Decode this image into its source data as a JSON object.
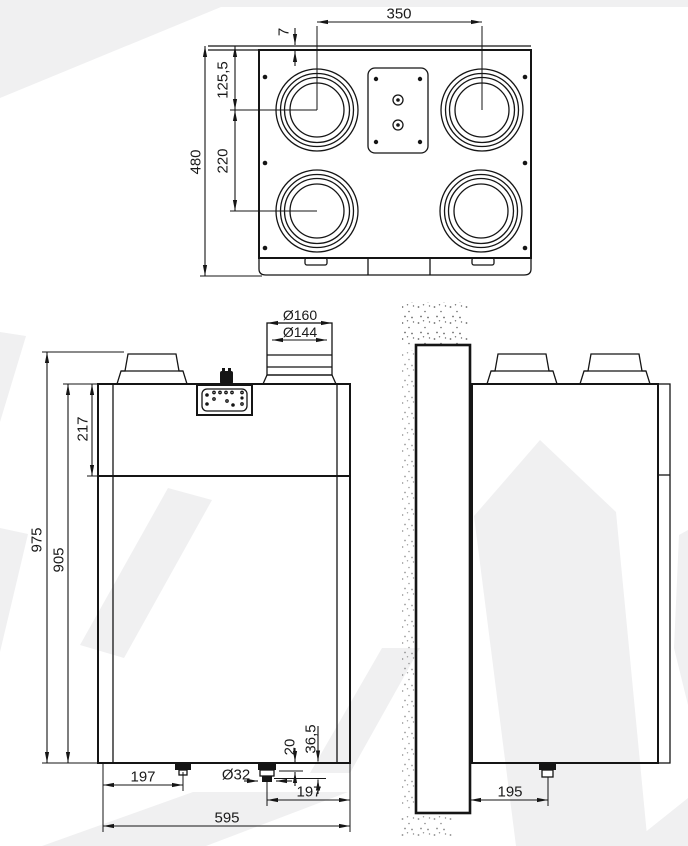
{
  "colors": {
    "line": "#151515",
    "watermark": "#f0f0f1",
    "paper": "#ffffff"
  },
  "top_view": {
    "dim_350": "350",
    "dim_7": "7",
    "dim_125_5": "125,5",
    "dim_220": "220",
    "dim_480": "480"
  },
  "front_view": {
    "dim_d160": "Ø160",
    "dim_d144": "Ø144",
    "dim_217": "217",
    "dim_975": "975",
    "dim_905": "905",
    "dim_197_left": "197",
    "dim_d32": "Ø32",
    "dim_20": "20",
    "dim_36_5": "36,5",
    "dim_197_right": "197",
    "dim_595": "595"
  },
  "side_view": {
    "dim_195": "195"
  }
}
